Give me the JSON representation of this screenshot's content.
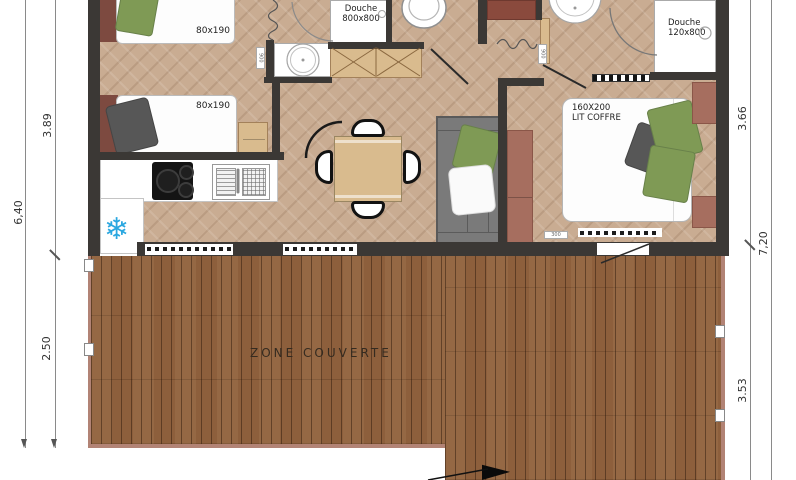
{
  "labels": {
    "bed1": "80x190",
    "bed2": "80x190",
    "shower1_l1": "Douche",
    "shower1_l2": "800x800",
    "shower2_l1": "Douche",
    "shower2_l2": "120x800",
    "master_l1": "160X200",
    "master_l2": "LIT COFFRE",
    "deck": "ZONE COUVERTE"
  },
  "dimensions": {
    "left_inner_top": "3.89",
    "left_outer": "6,40",
    "left_inner_bottom": "2.50",
    "right_inner_top": "3.66",
    "right_outer": "7,20",
    "right_inner_bottom": "3.53"
  },
  "tags": {
    "basin1": "900",
    "basin2": "900",
    "bedroom2_sill": "300"
  },
  "icons": {
    "snowflake_glyph": "❄"
  },
  "colors": {
    "wall": "#3b3835",
    "floor": "#c9ac92",
    "deck_wood": "#8d5f3c",
    "deck_border": "#b28375",
    "headboard_red": "#7d4a40",
    "wardrobe_red": "#a66e5f",
    "pillow_green": "#7f9a55",
    "pillow_gray": "#575757",
    "sofa_gray": "#7a7a7a",
    "furniture_wood": "#d9bb8e",
    "snowflake_blue": "#2aa7e0"
  }
}
